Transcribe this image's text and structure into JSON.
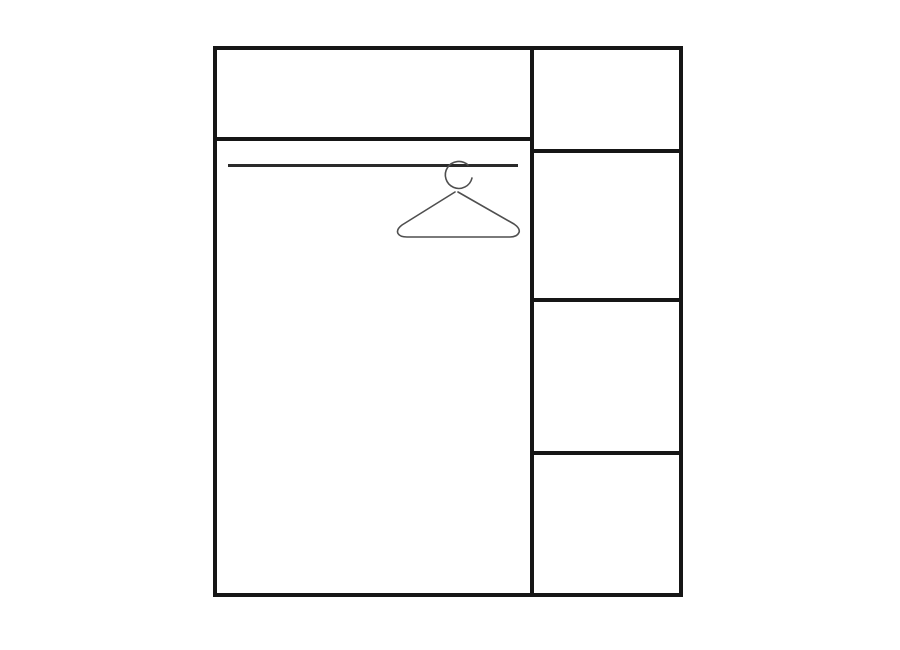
{
  "colors": {
    "bg": "#ffffff",
    "line": "#161616",
    "rail": "#2a2a2a",
    "hanger": "#4f4f4f"
  },
  "diagram": {
    "type": "wardrobe-interior-layout",
    "left_section": {
      "compartments": [
        {
          "name": "top-shelf-compartment"
        },
        {
          "name": "hanging-compartment",
          "features": [
            "clothes-rail",
            "clothes-hanger"
          ]
        }
      ]
    },
    "right_column": {
      "shelf_count": 4,
      "compartments": [
        {
          "name": "right-shelf-1"
        },
        {
          "name": "right-shelf-2"
        },
        {
          "name": "right-shelf-3"
        },
        {
          "name": "right-shelf-4"
        }
      ]
    }
  }
}
